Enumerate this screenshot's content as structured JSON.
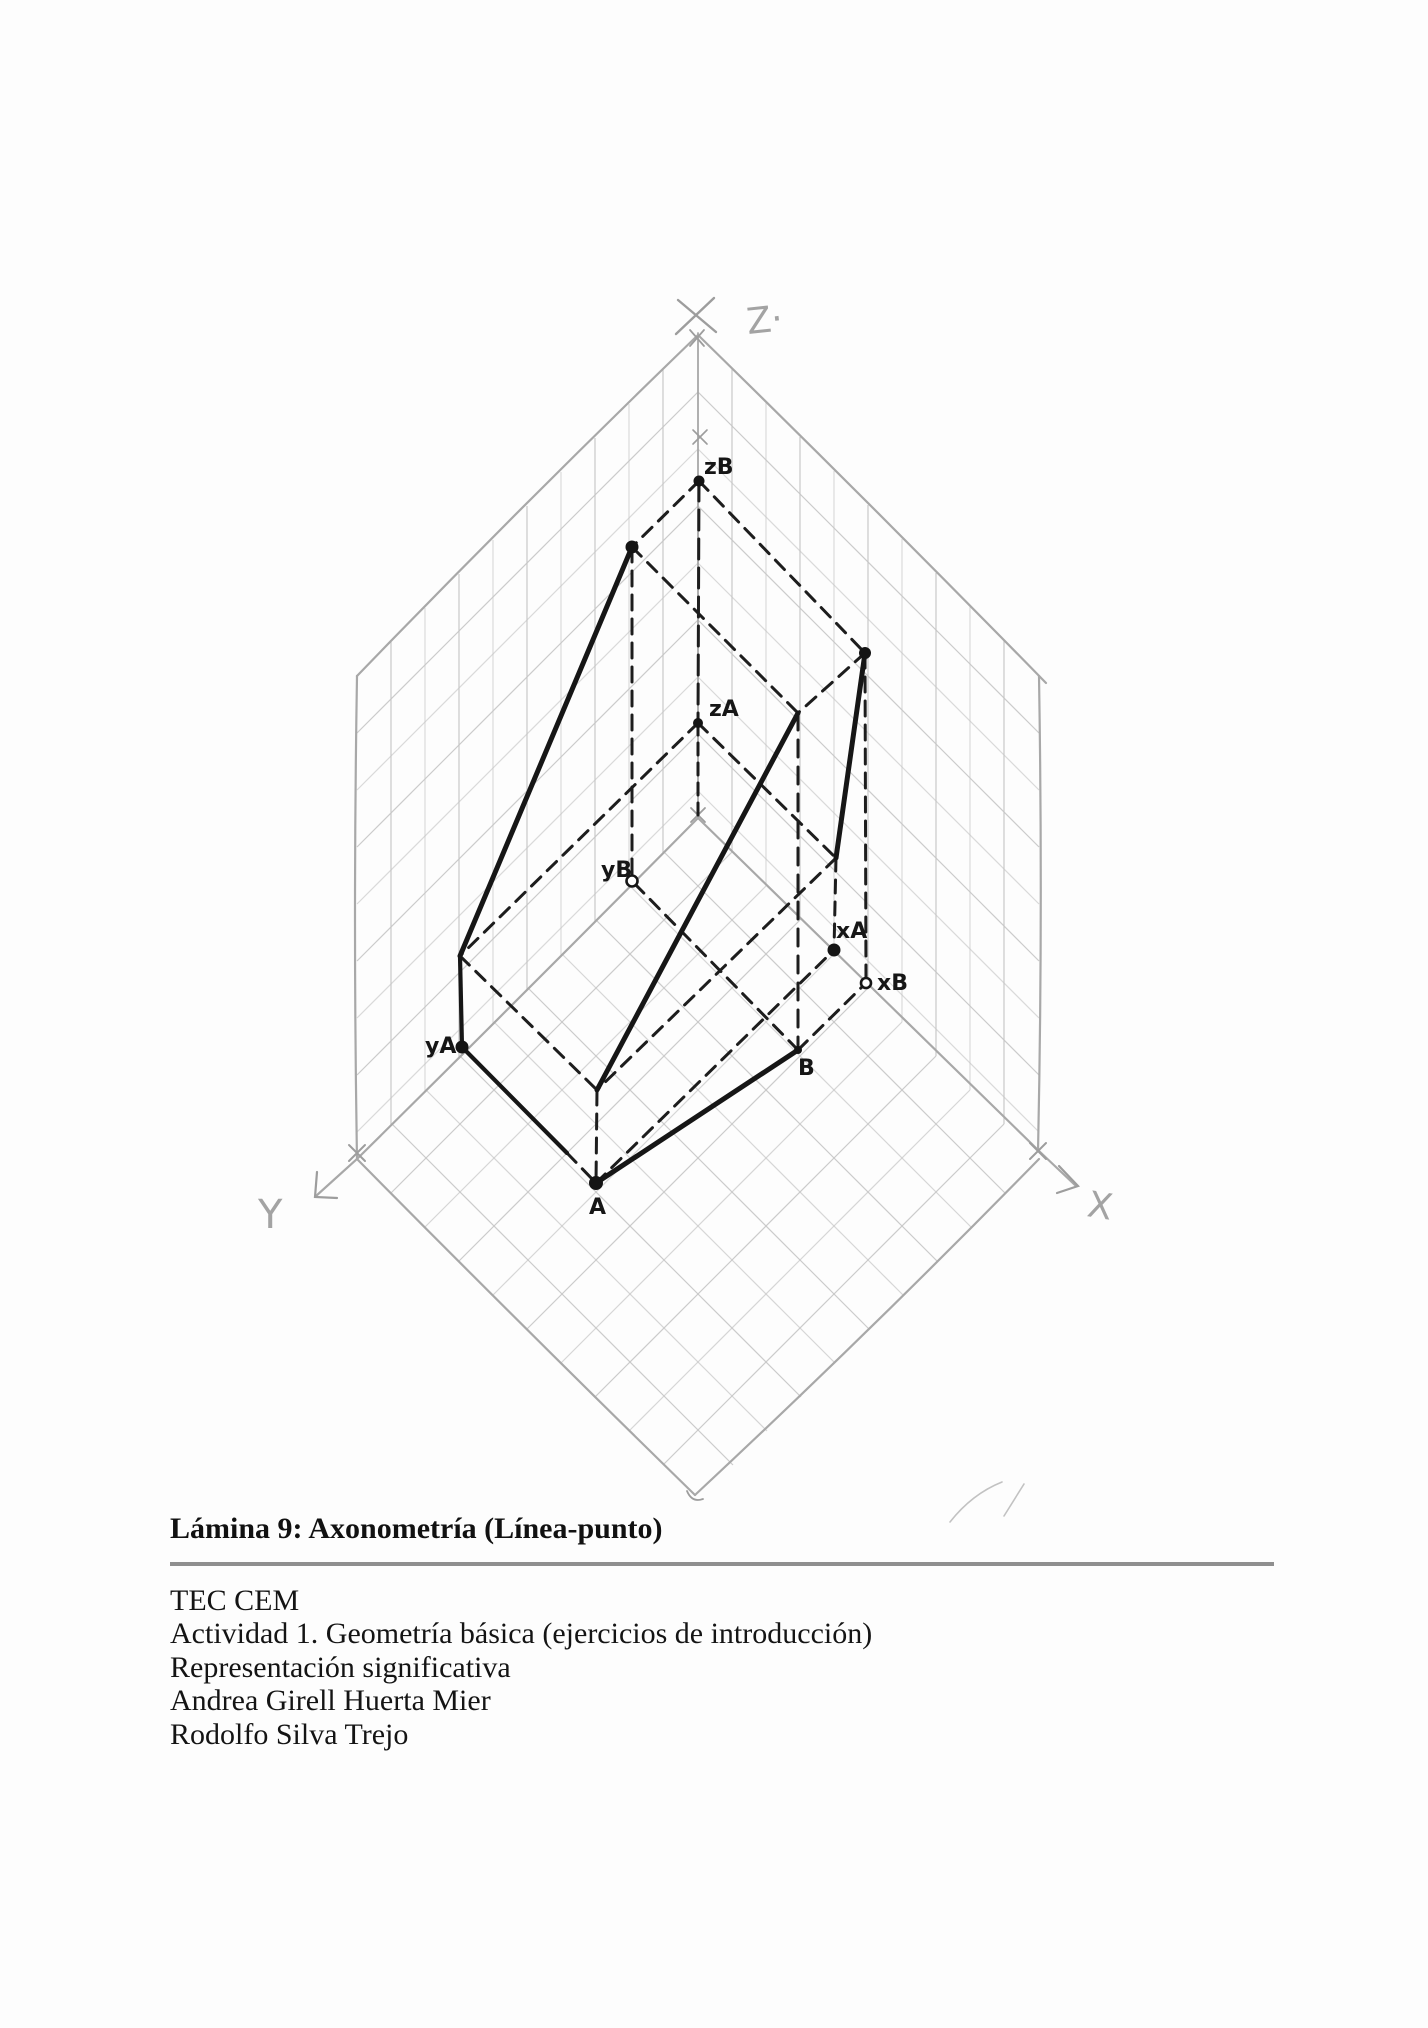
{
  "page": {
    "title": "Lámina 9: Axonometría (Línea-punto)",
    "credits": [
      "TEC CEM",
      "Actividad 1. Geometría básica (ejercicios de introducción)",
      "Representación significativa",
      "Andrea Girell Huerta Mier",
      "Rodolfo Silva Trejo"
    ]
  },
  "figure": {
    "axis_labels": {
      "z": "Z·",
      "y": "Y",
      "x": "X"
    },
    "point_labels": {
      "zB": "zB",
      "zA": "zA",
      "yB": "yB",
      "yA": "yA",
      "xA": "xA",
      "xB": "xB",
      "A": "A",
      "B": "B"
    }
  },
  "colors": {
    "ink": "#1b1b1b",
    "pencil": "#c6c6c6",
    "pencil_dark": "#a8a8a8",
    "rule": "#8f8f8f",
    "paper": "#fdfdfd"
  }
}
